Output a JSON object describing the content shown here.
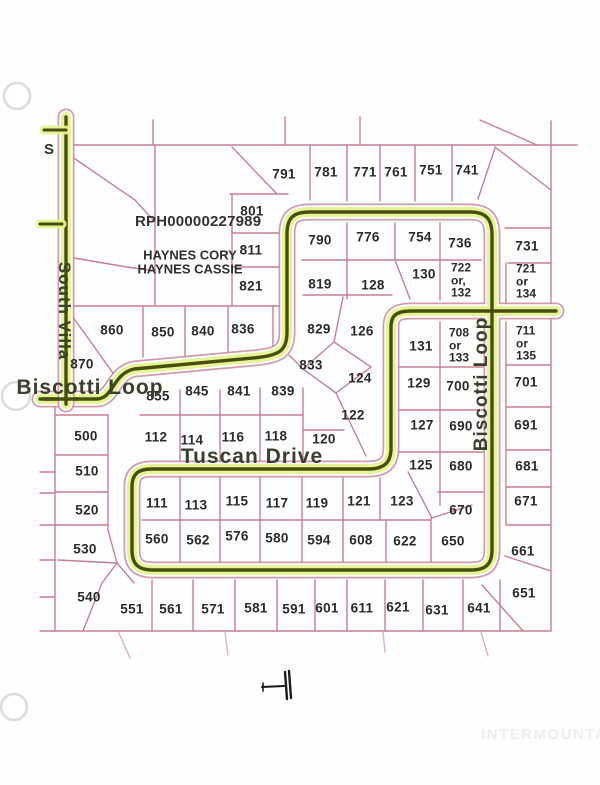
{
  "canvas": {
    "bg": "#fefefe"
  },
  "colors": {
    "parcel_line": "#c27386",
    "road_edge": "#c98ba0",
    "road_glow": "#e7f291",
    "road_core": "#454f0d",
    "lot_text": "#2b2b2b",
    "street_text": "#39402c",
    "watermark": "#ededed",
    "hole_ring": "#dcdcdc"
  },
  "plat": {
    "parcel_id_label": "RPH00000227989",
    "owner": [
      "HAYNES CORY",
      "HAYNES CASSIE"
    ],
    "edge_letter": "S",
    "streets": [
      {
        "id": "south-villa",
        "name": "South Villa",
        "x": 64,
        "y": 311,
        "rot": 90,
        "size": 17
      },
      {
        "id": "biscotti-loop-west",
        "name": "Biscotti Loop",
        "x": 90,
        "y": 388,
        "rot": 0,
        "size": 21
      },
      {
        "id": "tuscan-drive",
        "name": "Tuscan Drive",
        "x": 252,
        "y": 457,
        "rot": 0,
        "size": 21
      },
      {
        "id": "biscotti-loop-east",
        "name": "Biscotti Loop",
        "x": 482,
        "y": 384,
        "rot": -90,
        "size": 19
      }
    ],
    "lots": [
      {
        "n": "791",
        "x": 284,
        "y": 174
      },
      {
        "n": "781",
        "x": 326,
        "y": 172
      },
      {
        "n": "771",
        "x": 365,
        "y": 172
      },
      {
        "n": "761",
        "x": 396,
        "y": 172
      },
      {
        "n": "751",
        "x": 431,
        "y": 170
      },
      {
        "n": "741",
        "x": 467,
        "y": 170
      },
      {
        "n": "801",
        "x": 252,
        "y": 211
      },
      {
        "n": "811",
        "x": 251,
        "y": 250
      },
      {
        "n": "821",
        "x": 251,
        "y": 286
      },
      {
        "n": "790",
        "x": 320,
        "y": 240
      },
      {
        "n": "776",
        "x": 368,
        "y": 237
      },
      {
        "n": "754",
        "x": 420,
        "y": 237
      },
      {
        "n": "736",
        "x": 460,
        "y": 243
      },
      {
        "n": "819",
        "x": 320,
        "y": 284
      },
      {
        "n": "128",
        "x": 373,
        "y": 285
      },
      {
        "n": "130",
        "x": 424,
        "y": 274
      },
      {
        "n": "731",
        "x": 527,
        "y": 246
      },
      {
        "n": "860",
        "x": 112,
        "y": 330
      },
      {
        "n": "850",
        "x": 163,
        "y": 332
      },
      {
        "n": "840",
        "x": 203,
        "y": 331
      },
      {
        "n": "836",
        "x": 243,
        "y": 329
      },
      {
        "n": "870",
        "x": 82,
        "y": 364
      },
      {
        "n": "829",
        "x": 319,
        "y": 329
      },
      {
        "n": "126",
        "x": 362,
        "y": 331
      },
      {
        "n": "833",
        "x": 311,
        "y": 365
      },
      {
        "n": "124",
        "x": 360,
        "y": 378
      },
      {
        "n": "122",
        "x": 353,
        "y": 415
      },
      {
        "n": "120",
        "x": 324,
        "y": 439
      },
      {
        "n": "131",
        "x": 421,
        "y": 346
      },
      {
        "n": "129",
        "x": 419,
        "y": 383
      },
      {
        "n": "700",
        "x": 458,
        "y": 386
      },
      {
        "n": "127",
        "x": 422,
        "y": 425
      },
      {
        "n": "690",
        "x": 461,
        "y": 426
      },
      {
        "n": "125",
        "x": 421,
        "y": 465
      },
      {
        "n": "680",
        "x": 461,
        "y": 466
      },
      {
        "n": "701",
        "x": 526,
        "y": 382
      },
      {
        "n": "691",
        "x": 526,
        "y": 425
      },
      {
        "n": "681",
        "x": 527,
        "y": 466
      },
      {
        "n": "671",
        "x": 526,
        "y": 501
      },
      {
        "n": "661",
        "x": 523,
        "y": 551
      },
      {
        "n": "651",
        "x": 524,
        "y": 593
      },
      {
        "n": "855",
        "x": 158,
        "y": 396
      },
      {
        "n": "845",
        "x": 197,
        "y": 391
      },
      {
        "n": "841",
        "x": 239,
        "y": 391
      },
      {
        "n": "839",
        "x": 283,
        "y": 391
      },
      {
        "n": "112",
        "x": 156,
        "y": 437
      },
      {
        "n": "114",
        "x": 192,
        "y": 440
      },
      {
        "n": "116",
        "x": 233,
        "y": 437
      },
      {
        "n": "118",
        "x": 276,
        "y": 436
      },
      {
        "n": "500",
        "x": 86,
        "y": 436
      },
      {
        "n": "510",
        "x": 87,
        "y": 471
      },
      {
        "n": "520",
        "x": 87,
        "y": 510
      },
      {
        "n": "530",
        "x": 85,
        "y": 549
      },
      {
        "n": "540",
        "x": 89,
        "y": 597
      },
      {
        "n": "111",
        "x": 157,
        "y": 503
      },
      {
        "n": "113",
        "x": 196,
        "y": 505
      },
      {
        "n": "115",
        "x": 237,
        "y": 501
      },
      {
        "n": "117",
        "x": 277,
        "y": 503
      },
      {
        "n": "119",
        "x": 317,
        "y": 503
      },
      {
        "n": "121",
        "x": 359,
        "y": 501
      },
      {
        "n": "123",
        "x": 402,
        "y": 501
      },
      {
        "n": "670",
        "x": 461,
        "y": 510
      },
      {
        "n": "560",
        "x": 157,
        "y": 539
      },
      {
        "n": "562",
        "x": 198,
        "y": 540
      },
      {
        "n": "576",
        "x": 237,
        "y": 536
      },
      {
        "n": "580",
        "x": 277,
        "y": 538
      },
      {
        "n": "594",
        "x": 319,
        "y": 540
      },
      {
        "n": "608",
        "x": 361,
        "y": 540
      },
      {
        "n": "622",
        "x": 405,
        "y": 541
      },
      {
        "n": "650",
        "x": 453,
        "y": 541
      },
      {
        "n": "551",
        "x": 132,
        "y": 609
      },
      {
        "n": "561",
        "x": 171,
        "y": 609
      },
      {
        "n": "571",
        "x": 213,
        "y": 609
      },
      {
        "n": "581",
        "x": 256,
        "y": 608
      },
      {
        "n": "591",
        "x": 294,
        "y": 609
      },
      {
        "n": "601",
        "x": 327,
        "y": 608
      },
      {
        "n": "611",
        "x": 362,
        "y": 608
      },
      {
        "n": "621",
        "x": 398,
        "y": 607
      },
      {
        "n": "631",
        "x": 437,
        "y": 610
      },
      {
        "n": "641",
        "x": 479,
        "y": 608
      }
    ],
    "stacked_lots": [
      {
        "lines": "722\nor,\n132",
        "x": 461,
        "y": 280
      },
      {
        "lines": "721\nor\n134",
        "x": 526,
        "y": 281
      },
      {
        "lines": "708\nor\n133",
        "x": 459,
        "y": 345
      },
      {
        "lines": "711\nor\n135",
        "x": 526,
        "y": 343
      }
    ]
  },
  "footer": {
    "watermark": "INTERMOUNTAIN"
  }
}
